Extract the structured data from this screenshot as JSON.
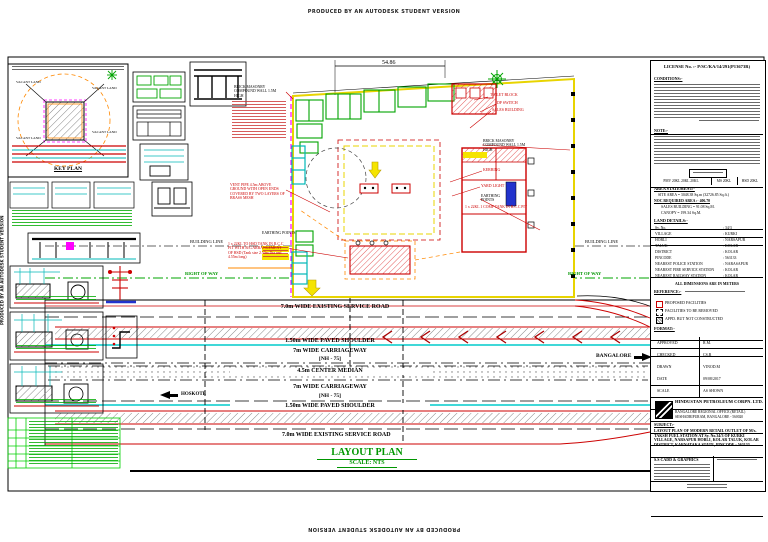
{
  "watermark": "PRODUCED BY AN AUTODESK STUDENT VERSION",
  "key_plan": {
    "caption": "KEY PLAN",
    "vacant": "VACANT LAND"
  },
  "plan": {
    "dim_top": "54.86",
    "building_line": "BUILDING LINE",
    "right_of_way": "RIGHT OF WAY",
    "earthing_points": "EARTHING POINTS",
    "ann_left": {
      "wall": "BRICK MASONRY COMPOUND WALL 1.5M HIGH",
      "vent": "VENT PIPE 4.5m ABOVE GROUND WITH OPEN ENDS COVERED BY TWO LAYERS OF BRASS MESH",
      "tank": "1 x 22KL TO HSD TANK IN R.C.C PIT WITH B/G ARRANGEMENT OF HSD (Tank size 2.50m Dia and 4.55m long)"
    },
    "ann_right": {
      "toilet": "TOILET BLOCK",
      "dp": "DP SWITCH",
      "sales": "SALES BUILDING",
      "wall": "BRICK MASONRY COMPOUND WALL 1.5M HIGH",
      "kerbing": "KERBING",
      "yard": "YARD LIGHT",
      "earthing": "EARTHING POINTS",
      "tank": "1 x 22KL 1 COMP TANK IN R.C.C PIT"
    },
    "layout_title": "LAYOUT PLAN",
    "layout_scale": "SCALE: NTS"
  },
  "roads": {
    "service_road": "7.0m WIDE EXISTING SERVICE ROAD",
    "paved_shoulder": "1.50m WIDE PAVED SHOULDER",
    "carriageway": "7m WIDE CARRIAGEWAY",
    "nh": "[NH - 75]",
    "median": "4.5m CENTER MEDIAN",
    "dest_left": "HOSKOTE",
    "dest_right": "BANGALORE"
  },
  "title_block": {
    "license": "LICENSE No. :- P/SC/KA/14/291(P13673R)",
    "conditions_heading": "CONDITIONS:-",
    "note_heading": "NOTE:-",
    "tank_row": [
      "PMV 20KL 20KL 20KL",
      "MS 20KL",
      "HSD 20KL"
    ],
    "area_heading": "AREA STATEMENT:-",
    "site_area": "SITE AREA = 3048.38 Sq.m (32726.85 Sq.ft.)",
    "noc_area": "NOC REQUIRED AREA :- 406.70",
    "sales_building": "SALES BUILDING = 91.08 Sq.M.",
    "canopy": "CANOPY = 199.34 Sq.M.",
    "land_heading": "LAND DETAILS:-",
    "land_rows": [
      [
        "Sy. No.",
        ": 34/3"
      ],
      [
        "VILLAGE",
        ": KURKI"
      ],
      [
        "HOBLI",
        ": NARSAPUR"
      ],
      [
        "TALUK",
        ": KOLAR"
      ],
      [
        "DISTRICT",
        ": KOLAR"
      ],
      [
        "PINCODE",
        ": 563133"
      ],
      [
        "NEAREST POLICE STATION",
        ": NARASAPUR"
      ],
      [
        "NEAREST FIRE SERVICE STATION",
        ": KOLAR"
      ],
      [
        "NEAREST RAILWAY STATION",
        ": KOLAR"
      ]
    ],
    "dims_note": "ALL DIMENSIONS ARE IN METERS",
    "reference_heading": "REFERENCE:-",
    "legend_items": [
      "PROPOSED FACILITIES",
      "FACILITIES TO BE REMOVED",
      "APPD. BUT NOT CONSTRUCTED"
    ],
    "format_heading": "FORMAT:-",
    "format_rows": [
      [
        "APPROVED",
        "R.M."
      ],
      [
        "CHECKED",
        "CS.R"
      ],
      [
        "DRAWN",
        "VINOD.M"
      ],
      [
        "DATE",
        "09/08/2017"
      ],
      [
        "SCALE",
        "AS SHOWN"
      ]
    ],
    "company": "HINDUSTAN PETROLEUM CORPN. LTD.",
    "company_line2": "BANGALORE REGIONAL OFFICE (RETAIL)",
    "company_line3": "SESHADRIPURAM, BANGALORE - 560020",
    "subject_heading": "SUBJECT:-",
    "subject": "LAYOUT PLAN OF MODERN RETAIL OUTLET OF M/s. TAKSH FUEL STATION AT Sy. No.34/3 OF KURKI VILLAGE, NARSAPUR HOBLI, KOLAR TALUK, KOLAR DISTRICT, KARNATAKA STATE, PINCODE - 563133",
    "consultant": "S.S CADD & GRAPHICS"
  },
  "colors": {
    "accent_red": "#cc0000",
    "accent_green": "#00a400",
    "accent_cyan": "#00cccc",
    "accent_yellow": "#f2e400",
    "accent_magenta": "#ff00ff",
    "accent_orange": "#ff8800",
    "accent_blue": "#2233cc"
  }
}
